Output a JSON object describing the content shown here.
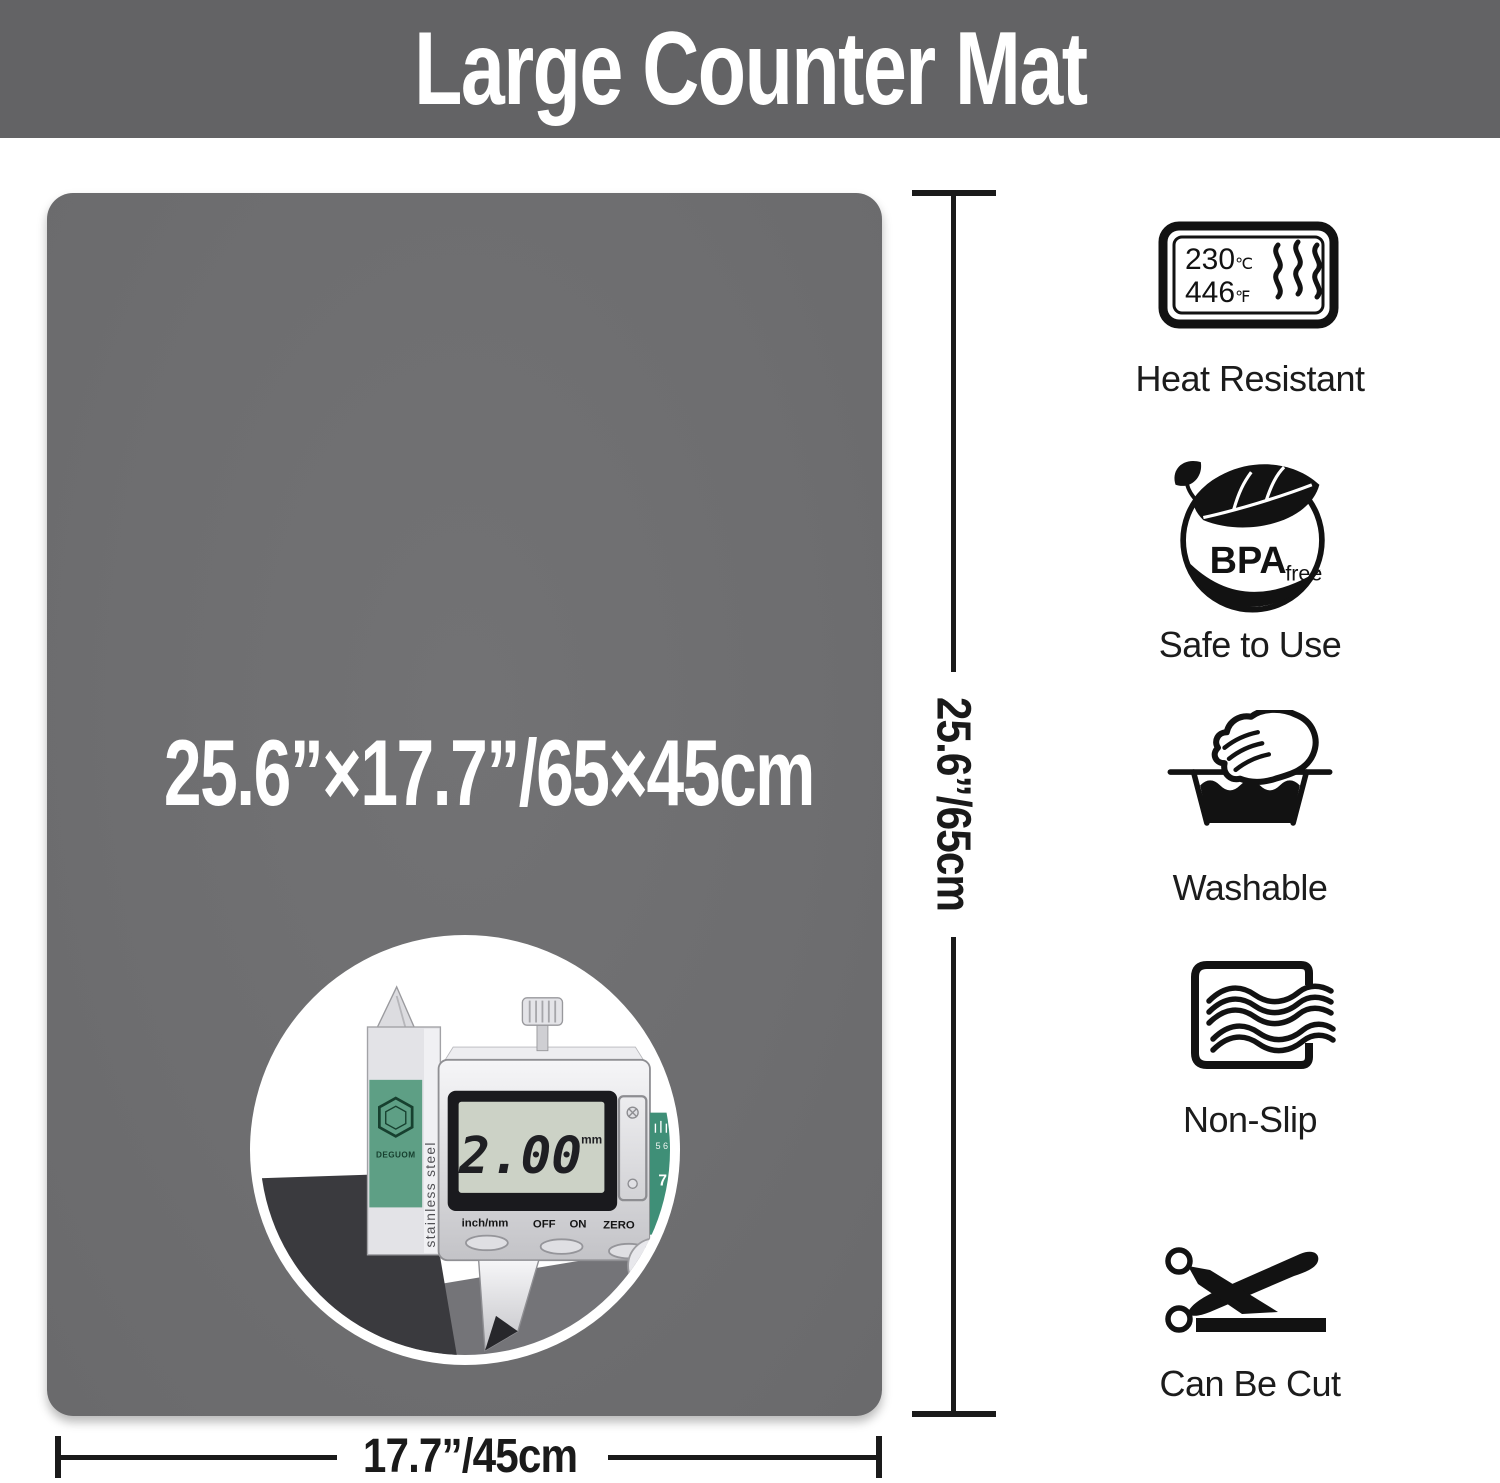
{
  "banner": {
    "title": "Large Counter Mat"
  },
  "mat": {
    "size_label": "25.6”×17.7”/65×45cm",
    "thickness_label": "0.08”/2mm"
  },
  "dims": {
    "height_label": "25.6”/65cm",
    "width_label": "17.7”/45cm"
  },
  "inset": {
    "display_value": "2.00",
    "display_unit": "mm",
    "mode_button": "inch/mm",
    "buttons": [
      "OFF",
      "ON",
      "ZERO"
    ],
    "brand": "DEGUOM",
    "beam_text": "stainless steel",
    "scale_small": "5 6",
    "scale_big": "7"
  },
  "features": [
    {
      "label": "Heat Resistant",
      "temp_c": "230",
      "temp_c_unit": "℃",
      "temp_f": "446",
      "temp_f_unit": "℉"
    },
    {
      "label": "Safe to Use",
      "badge": "BPA",
      "badge_sub": "free"
    },
    {
      "label": "Washable"
    },
    {
      "label": "Non-Slip"
    },
    {
      "label": "Can Be Cut"
    }
  ],
  "colors": {
    "banner_bg": "#636365",
    "mat": "#6e6e70",
    "line": "#1a1a1a",
    "caliper_green": "#3f8f77",
    "icon_black": "#121212"
  }
}
